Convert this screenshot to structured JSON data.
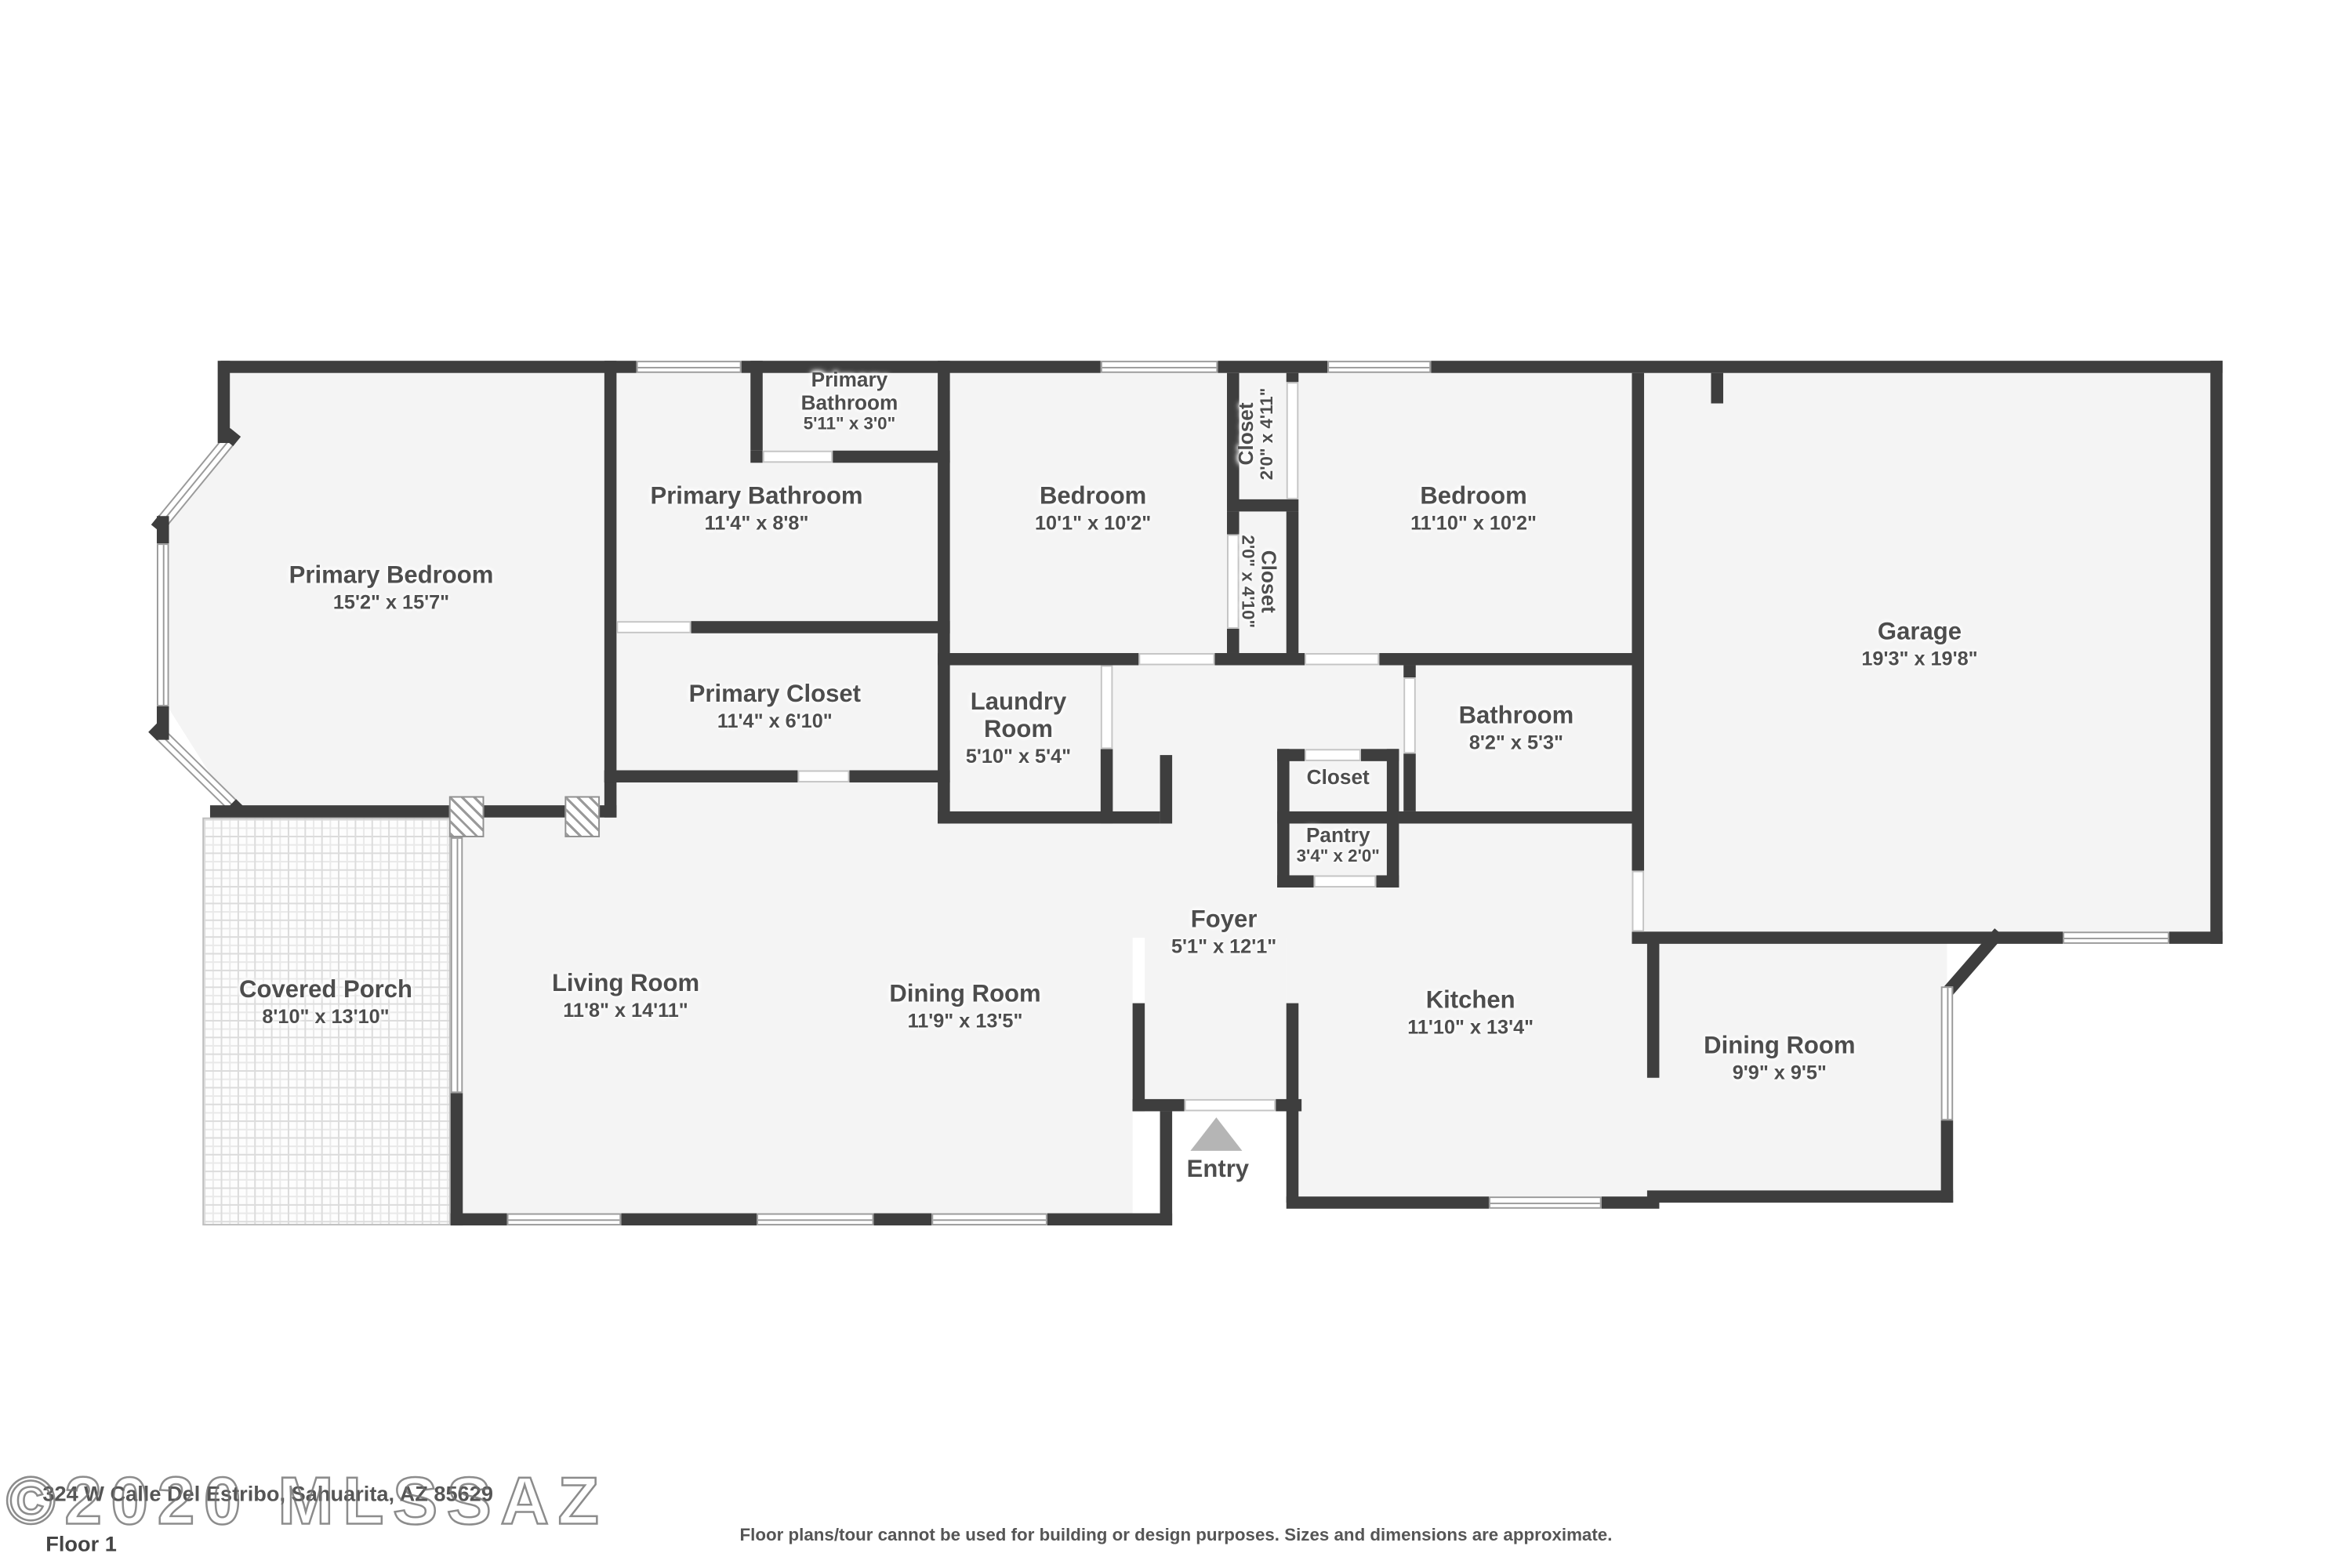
{
  "colors": {
    "wall": "#3e3e3e",
    "floor": "#f4f4f4",
    "entry_triangle": "#b5b5b5",
    "label_text": "#4d4d4d"
  },
  "rooms": [
    {
      "id": "primary-bedroom",
      "label": "Primary Bedroom",
      "dims": "15'2\" x 15'7\""
    },
    {
      "id": "primary-bathroom-small",
      "label": "Primary\nBathroom",
      "dims": "5'11\" x 3'0\""
    },
    {
      "id": "primary-bathroom",
      "label": "Primary Bathroom",
      "dims": "11'4\" x 8'8\""
    },
    {
      "id": "bedroom-1",
      "label": "Bedroom",
      "dims": "10'1\" x 10'2\""
    },
    {
      "id": "closet-bedroom-2",
      "label": "Closet",
      "dims": "2'0\" x 4'11\""
    },
    {
      "id": "closet-bedroom-1",
      "label": "Closet",
      "dims": "2'0\" x 4'10\""
    },
    {
      "id": "bedroom-2",
      "label": "Bedroom",
      "dims": "11'10\" x 10'2\""
    },
    {
      "id": "garage",
      "label": "Garage",
      "dims": "19'3\" x 19'8\""
    },
    {
      "id": "primary-closet",
      "label": "Primary Closet",
      "dims": "11'4\" x 6'10\""
    },
    {
      "id": "laundry-room",
      "label": "Laundry\nRoom",
      "dims": "5'10\" x 5'4\""
    },
    {
      "id": "bathroom",
      "label": "Bathroom",
      "dims": "8'2\" x 5'3\""
    },
    {
      "id": "hall-closet",
      "label": "Closet",
      "dims": ""
    },
    {
      "id": "pantry",
      "label": "Pantry",
      "dims": "3'4\" x 2'0\""
    },
    {
      "id": "foyer",
      "label": "Foyer",
      "dims": "5'1\" x 12'1\""
    },
    {
      "id": "covered-porch",
      "label": "Covered Porch",
      "dims": "8'10\" x 13'10\""
    },
    {
      "id": "living-room",
      "label": "Living Room",
      "dims": "11'8\" x 14'11\""
    },
    {
      "id": "dining-room",
      "label": "Dining Room",
      "dims": "11'9\" x 13'5\""
    },
    {
      "id": "kitchen",
      "label": "Kitchen",
      "dims": "11'10\" x 13'4\""
    },
    {
      "id": "dining-room-2",
      "label": "Dining Room",
      "dims": "9'9\" x 9'5\""
    }
  ],
  "entry": {
    "label": "Entry"
  },
  "footer": {
    "watermark": "©2020 MLSSAZ",
    "address": "324 W Calle Del Estribo, Sahuarita, AZ 85629",
    "floor_label": "Floor 1",
    "disclaimer": "Floor plans/tour cannot be used for building or design purposes. Sizes and dimensions are approximate."
  }
}
